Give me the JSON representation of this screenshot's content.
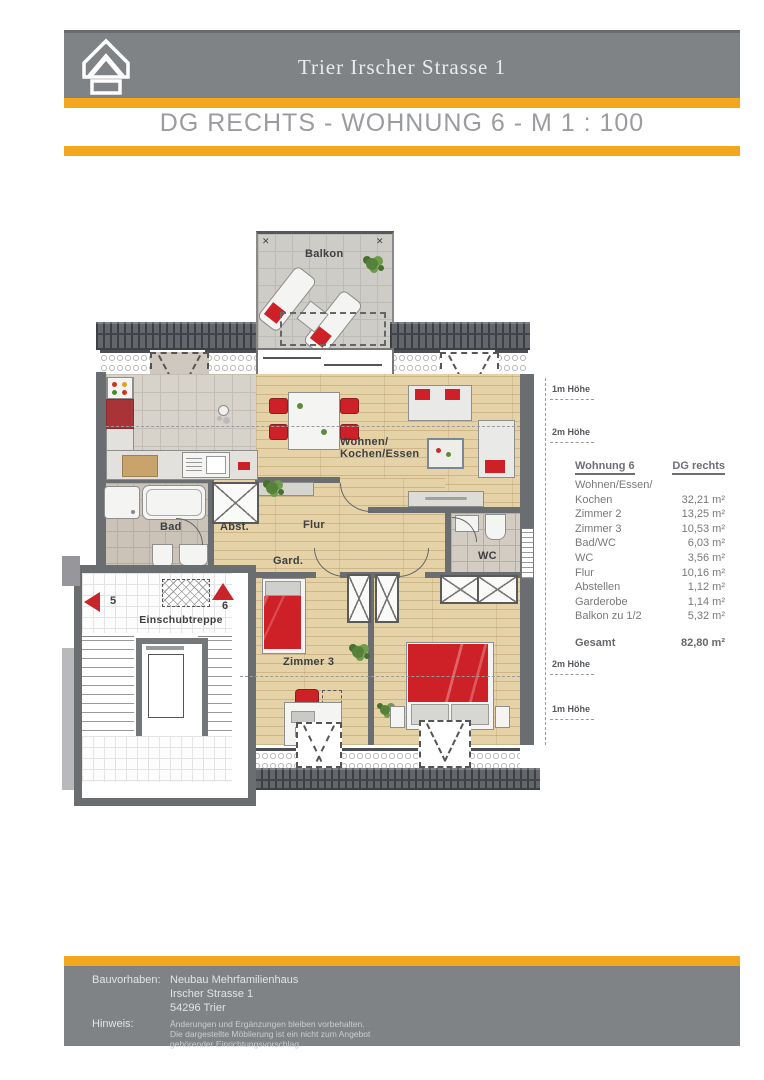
{
  "header": {
    "title": "Trier Irscher Strasse 1",
    "subtitle": "DG RECHTS - WOHNUNG 6 - M 1 : 100"
  },
  "colors": {
    "accent_orange": "#F3A71F",
    "band_gray": "#808386",
    "furniture_red": "#CE2127",
    "wood_floor": "#E6D2A7",
    "wall_gray": "#6B6E71"
  },
  "icons": {
    "logo": "house-outline",
    "balcony_anchor": "✕",
    "stair_up_arrow": "red-triangle-up",
    "stair_left_arrow": "red-triangle-left"
  },
  "plan": {
    "labels": {
      "balkon": "Balkon",
      "wohnen_line1": "Wohnen/",
      "wohnen_line2": "Kochen/Essen",
      "bad": "Bad",
      "abst": "Abst.",
      "flur": "Flur",
      "gard": "Gard.",
      "wc": "WC",
      "zimmer3": "Zimmer 3",
      "einschubtreppe": "Einschubtreppe",
      "stair_left_number": "5",
      "stair_right_number": "6"
    },
    "height_annotations": {
      "top_1m": "1m Höhe",
      "top_2m": "2m Höhe",
      "bottom_2m": "2m Höhe",
      "bottom_1m": "1m Höhe"
    }
  },
  "area_table": {
    "header": {
      "col1": "Wohnung 6",
      "col2": "DG rechts"
    },
    "rows": [
      {
        "label": "Wohnen/Essen/",
        "value": ""
      },
      {
        "label": "Kochen",
        "value": "32,21 m²"
      },
      {
        "label": "Zimmer 2",
        "value": "13,25 m²"
      },
      {
        "label": "Zimmer 3",
        "value": "10,53 m²"
      },
      {
        "label": "Bad/WC",
        "value": "6,03 m²"
      },
      {
        "label": "WC",
        "value": "3,56 m²"
      },
      {
        "label": "Flur",
        "value": "10,16 m²"
      },
      {
        "label": "Abstellen",
        "value": "1,12 m²"
      },
      {
        "label": "Garderobe",
        "value": "1,14 m²"
      },
      {
        "label": "Balkon zu 1/2",
        "value": "5,32 m²"
      }
    ],
    "total": {
      "label": "Gesamt",
      "value": "82,80 m²"
    }
  },
  "footer": {
    "bauvorhaben_label": "Bauvorhaben:",
    "bauvorhaben_lines": [
      "Neubau Mehrfamilienhaus",
      "Irscher Strasse 1",
      "54296 Trier"
    ],
    "hinweis_label": "Hinweis:",
    "hinweis_lines": [
      "Änderungen und Ergänzungen bleiben vorbehalten.",
      "Die dargestellte Möblierung ist ein nicht zum Angebot",
      "gehörender Einrichtungsvorschlag."
    ]
  }
}
